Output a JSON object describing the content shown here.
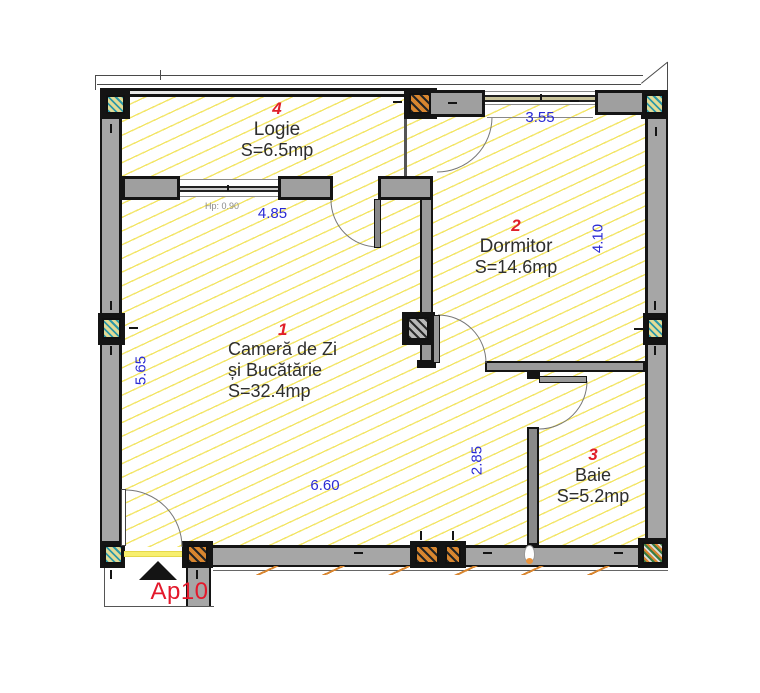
{
  "plan": {
    "entrance": {
      "label": "Ap10"
    },
    "rooms": {
      "living": {
        "number": "1",
        "name_line1": "Cameră de Zi",
        "name_line2": "și Bucătărie",
        "area": "S=32.4mp"
      },
      "dormitor": {
        "number": "2",
        "name": "Dormitor",
        "area": "S=14.6mp"
      },
      "baie": {
        "number": "3",
        "name": "Baie",
        "area": "S=5.2mp"
      },
      "logie": {
        "number": "4",
        "name": "Logie",
        "area": "S=6.5mp"
      }
    },
    "dimensions": {
      "dormitor_width": "3.55",
      "logie_window_width": "4.85",
      "parapet_height": "Hp: 0.90",
      "dormitor_depth": "4.10",
      "living_depth": "5.65",
      "hall_depth": "2.85",
      "living_width": "6.60"
    },
    "colors": {
      "dimension_blue": "#2a2ad4",
      "room_number_red": "#e0202a",
      "label_black": "#2e2e2e",
      "wall_gray": "#a6a6a6",
      "wall_outline": "#141414",
      "hatch_yellow": "#f0e460",
      "hatch_orange": "#d9862f",
      "hatch_teal": "#2f99a8",
      "threshold_yellow": "#f7ef6e"
    }
  }
}
